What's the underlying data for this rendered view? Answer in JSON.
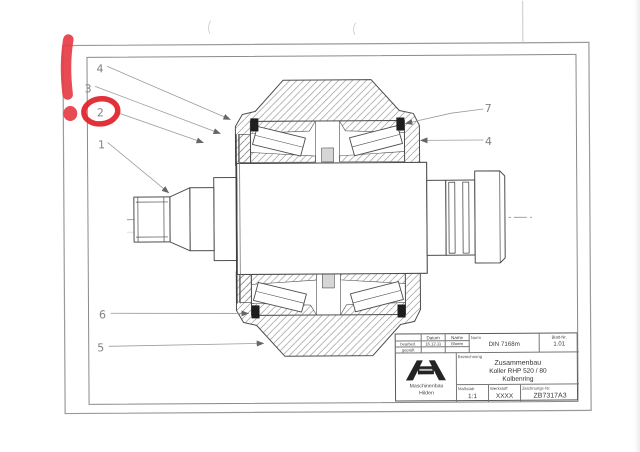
{
  "callouts": {
    "c1": "1",
    "c2": "2",
    "c3": "3",
    "c4a": "4",
    "c4b": "4",
    "c5": "5",
    "c6": "6",
    "c7": "7"
  },
  "annotations": {
    "exclamation_mark": "!",
    "circled_callout": "2"
  },
  "title_block": {
    "datum_header": "Datum",
    "name_header": "Name",
    "bearbeitet_label": "bearbeit.",
    "bearbeitet_datum": "16.12.11",
    "bearbeitet_name": "Bloem",
    "geprueft_label": "geprüft",
    "norm_label": "Norm",
    "norm_value": "DIN 7168m",
    "blatt_label": "Blatt-Nr.",
    "blatt_value": "1.01",
    "bezeichnung_label": "Bezeichnung",
    "title_line1": "Zusammenbau",
    "title_line2": "Koller RHP 520 / 80",
    "title_line3": "Kolbenring",
    "massstab_label": "Maßstab",
    "massstab_value": "1:1",
    "werkstoff_label": "Werkstoff",
    "werkstoff_value": "XXXX",
    "zeichnung_label": "Zeichnungs-Nr.",
    "zeichnung_value": "ZB7317A3",
    "company_line1": "Maschinenbau",
    "company_line2": "Hilden"
  },
  "colors": {
    "annotation_red": "#e63c44",
    "line_gray": "#555555",
    "frame_gray": "#8f8f8f"
  }
}
